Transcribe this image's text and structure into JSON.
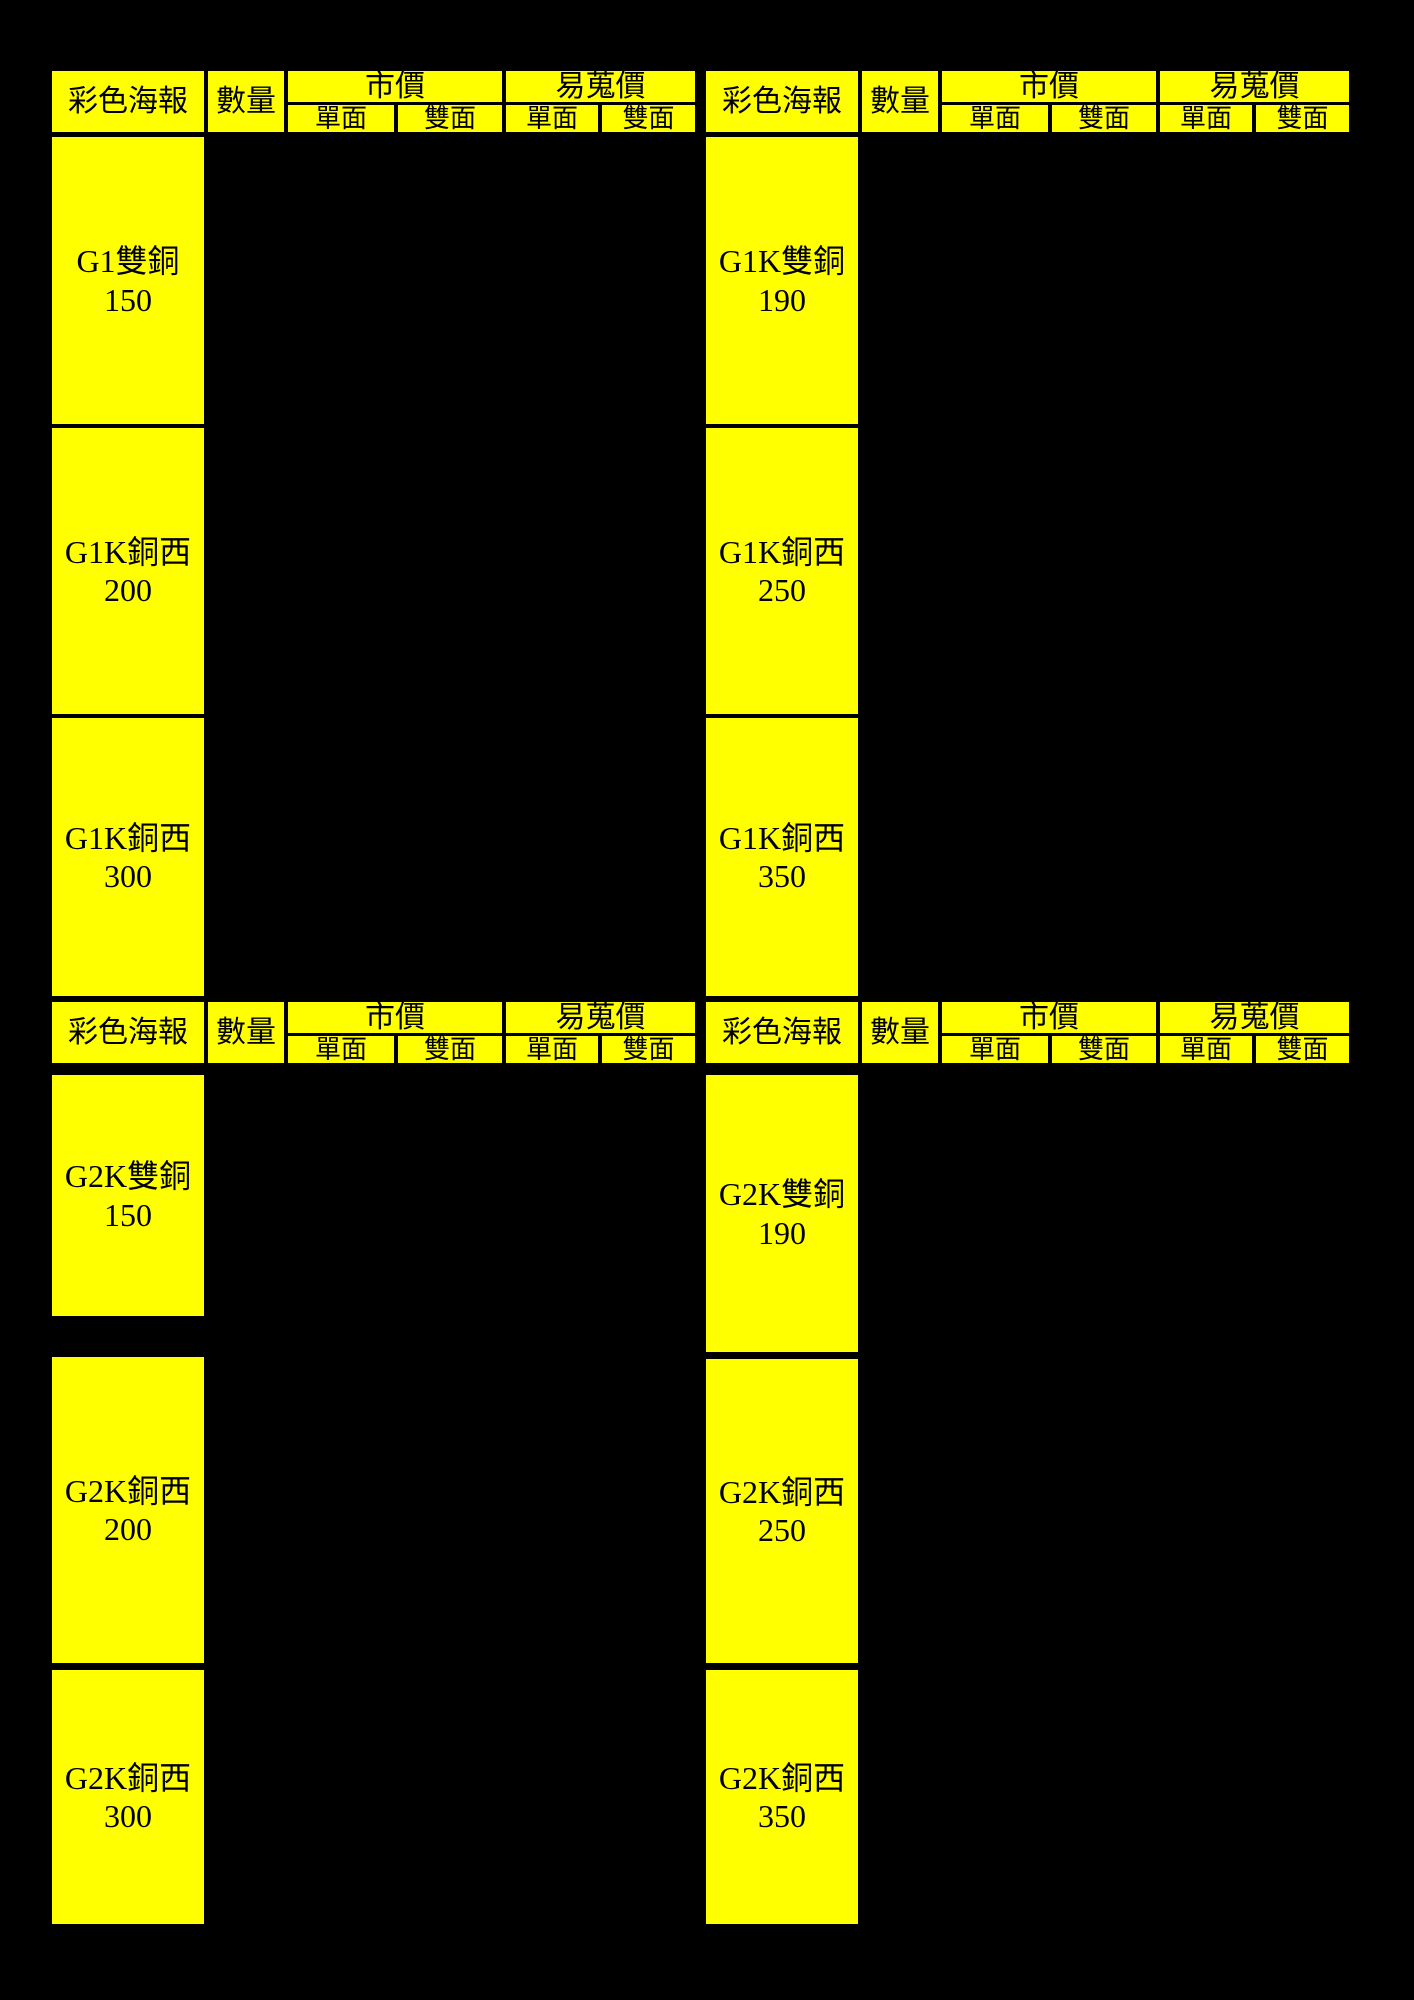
{
  "colors": {
    "cell_background": "#ffff00",
    "page_background": "#000000",
    "text": "#000000"
  },
  "header": {
    "poster_col": "彩色海報",
    "quantity_col": "數量",
    "market_price_col": "市價",
    "easy_find_price_col": "易蒐價",
    "single_sided": "單面",
    "double_sided": "雙面"
  },
  "sections": [
    {
      "tables": [
        {
          "rows": [
            {
              "name": "G1雙銅",
              "value": "150"
            },
            {
              "name": "G1K銅西",
              "value": "200"
            },
            {
              "name": "G1K銅西",
              "value": "300"
            }
          ]
        },
        {
          "rows": [
            {
              "name": "G1K雙銅",
              "value": "190"
            },
            {
              "name": "G1K銅西",
              "value": "250"
            },
            {
              "name": "G1K銅西",
              "value": "350"
            }
          ]
        }
      ]
    },
    {
      "tables": [
        {
          "rows": [
            {
              "name": "G2K雙銅",
              "value": "150"
            },
            {
              "name": "G2K銅西",
              "value": "200"
            },
            {
              "name": "G2K銅西",
              "value": "300"
            }
          ]
        },
        {
          "rows": [
            {
              "name": "G2K雙銅",
              "value": "190"
            },
            {
              "name": "G2K銅西",
              "value": "250"
            },
            {
              "name": "G2K銅西",
              "value": "350"
            }
          ]
        }
      ]
    }
  ]
}
